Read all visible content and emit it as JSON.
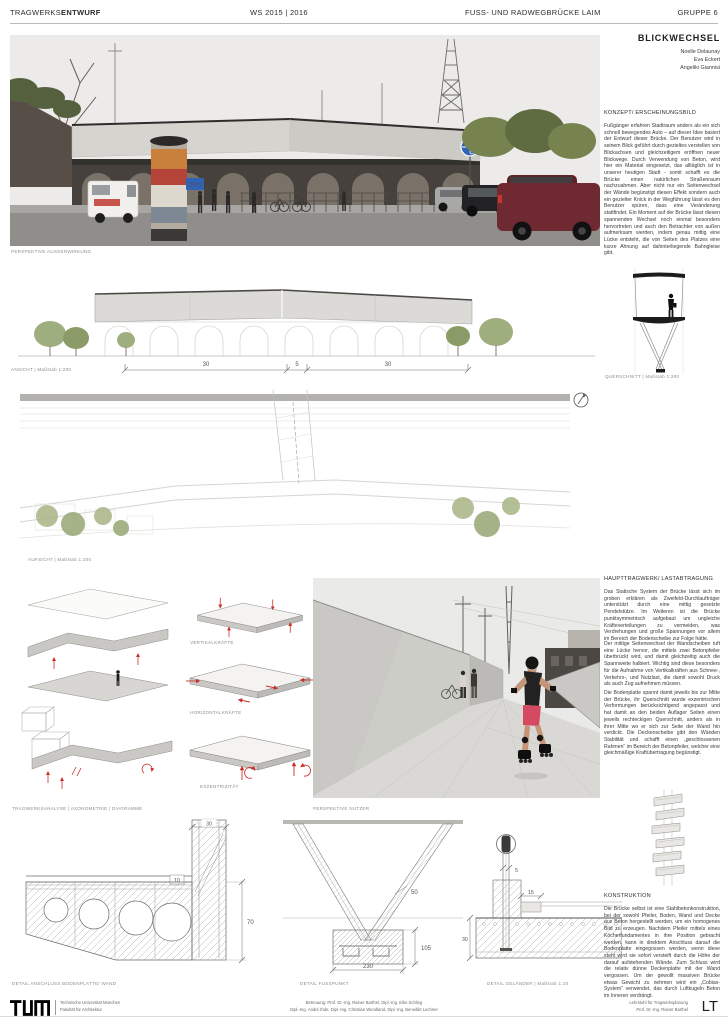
{
  "header": {
    "title_light": "TRAGWERKS",
    "title_bold": "ENTWURF",
    "semester": "WS 2015 | 2016",
    "project": "FUSS- UND RADWEGBRÜCKE LAIM",
    "group": "GRUPPE 6"
  },
  "sidebar": {
    "project_title": "BLICKWECHSEL",
    "authors": [
      "Noelle Delaunay",
      "Eva Eckert",
      "Angeliki Giannisi"
    ],
    "concept_heading": "KONZEPT/ ERSCHEINUNGSBILD",
    "concept_body": "Fußgänger erfahren Stadtraum anders als ein sich schnell bewegendes Auto – auf dieser Idee basiert der Entwurf dieser Brücke. Der Benutzer wird in seinem Blick geführt durch gezieltes verstellen von Blickachsen und gleichzeitigem eröffnen neuer Blickwege. Durch Verwendung von Beton, wird hier ein Material eingesetzt, das alltäglich ist in unserer heutigen Stadt - somit schafft es die Brücke einen natürlichen Straßenraum nachzuahmen. Aber nicht nur ein Seitenwechsel der Wände begünstigt diesen Effekt sondern auch ein gezielter Knick in der Wegführung lässt es den Benutzer spüren, dass eine Veränderung stattfindet. Ein Moment auf der Brücke lässt diesen spannenden Wechsel noch einmal besonders hervortreten und auch den Betrachter von außen aufmerksam werden, indem genau mittig eine Lücke entsteht, die von Seiten des Platzes eine kurze Ahnung auf dahinterliegende Bahngleise gibt.",
    "structure_heading": "HAUPTTRAGWERK/ LASTABTRAGUNG",
    "structure_p1": "Das Statische System der Brücke lässt sich im groben erklären als Zweifeld-Durchlaufträger unterstützt durch eine mittig gesetzte Pendelstütze. Im Weiteren ist die Brücke punktsymmetrisch aufgebaut um ungleiche Kräfteverteilungen zu vermeiden, was Verdrehungen und große Spannungen vor allem im Bereich der Bodenscheibe zur Folge hätte.",
    "structure_p2": "Der mittige Seitenwechsel der Wandscheiben ruft eine Lücke hervor, die mittels zwei Betonpfeiler überbrückt wird, und damit gleichzeitig auch die Spannweite halbiert. Wichtig sind diese besonders für die Aufnahme von Vertikalkräften aus Schnee-, Verkehrs-, und Nutzlast, die damit sowohl Druck als auch Zug aufnehmen müssen.",
    "structure_p3": "Die Bodenplatte spannt damit jeweils bis zur Mitte der Brücke, ihr Querschnitt wurde exzentrischen Verformungen berücksichtigend angepasst und hat damit an den beiden Auflager Seiten einen jeweils rechteckigen Querschnitt, anders als in ihrer Mitte wo er sich zur Seite der Wand hin verdickt. Die Deckenscheibe gibt den Wänden Stabilität und schafft einen „geschlossenen Rahmen“ im Bereich der Betonpfeiler, welcher eine gleichmäßige Kraftübertragung begünstigt.",
    "construction_heading": "KONSTRUKTION",
    "construction_body": "Die Brücke selbst ist eine Stahlbetonkonstruktion, bei der sowohl Pfeiler, Boden, Wand und Decke aus Beton hergestellt werden, um ein homogenes Bild zu erzeugen. Nachdem Pfeiler mittels eines Köcherfundamentes in ihre Position gebracht werden, kann in direktem Anschluss darauf die Bodenplatte eingegossen werden, wenn diese steht wird sie sofort versteift durch die Höhe der darauf aufstehenden Wände. Zum Schluss wird die relativ dünne Deckenplatte mit der Wand vergossen. Um der gewollt massiven Brücke etwas Gewicht zu nehmen wird ein „Cobiax-System“ verwendet, das durch Luftkugeln Beton im Inneren verdrängt."
  },
  "captions": {
    "exterior": "PERSPEKTIVE AUSSENWIRKUNG",
    "elevation": "ANSICHT  |  Maßstab 1:200",
    "section": "QUERSCHNITT  |  Maßstab 1:200",
    "plan": "AUFSICHT  |  Maßstab 1:200",
    "analysis": "TRAGWERKSANALYSE  |  AXONOMETRIE  |  DIAGRAMME",
    "user": "PERSPEKTIVE NUTZER",
    "detail_wall": "DETAIL ANSCHLUSS BODENPLATTE/ WAND",
    "detail_foot": "DETAIL FUSSPUNKT",
    "detail_railing": "DETAIL GELÄNDER  |  Maßstab 1:20"
  },
  "diagrams": {
    "vertical": "VERTIKALKRÄFTE",
    "horizontal": "HORIZONTALKRÄFTE",
    "eccentricity": "EXZENTRIZITÄT"
  },
  "dims": {
    "elevation_left": "30",
    "elevation_mid": "5",
    "elevation_right": "30",
    "wall_width": "30",
    "deck_layer": "10",
    "slab_height": "70",
    "pillar_width": "50",
    "foundation_height": "105",
    "foundation_width": "230",
    "railing_post": "5",
    "railing_ledge": "15",
    "railing_slab": "30"
  },
  "photo": {
    "speed_sign": "30m"
  },
  "footer": {
    "university": "Technische Universität München",
    "faculty": "Fakultät für Architektur",
    "supervision1": "Betreuung: Prof. Dr.-Ing. Rainer Barthel, Dipl.-Ing. Eike Schling",
    "supervision2": "Dipl.-Ing. André Ihde, Dipl.-Ing. Christian Wendland, Dipl.-Ing. Benedikt Lechner",
    "chair1": "Lehrstuhl für Tragwerksplanung",
    "chair2": "Prof. Dr.-Ing. Rainer Barthel",
    "lt": "LT"
  },
  "colors": {
    "accent_red": "#c9302a",
    "tree_green": "#a8b587",
    "sign_blue": "#2f63b5",
    "concrete": "#d5d4cf"
  }
}
